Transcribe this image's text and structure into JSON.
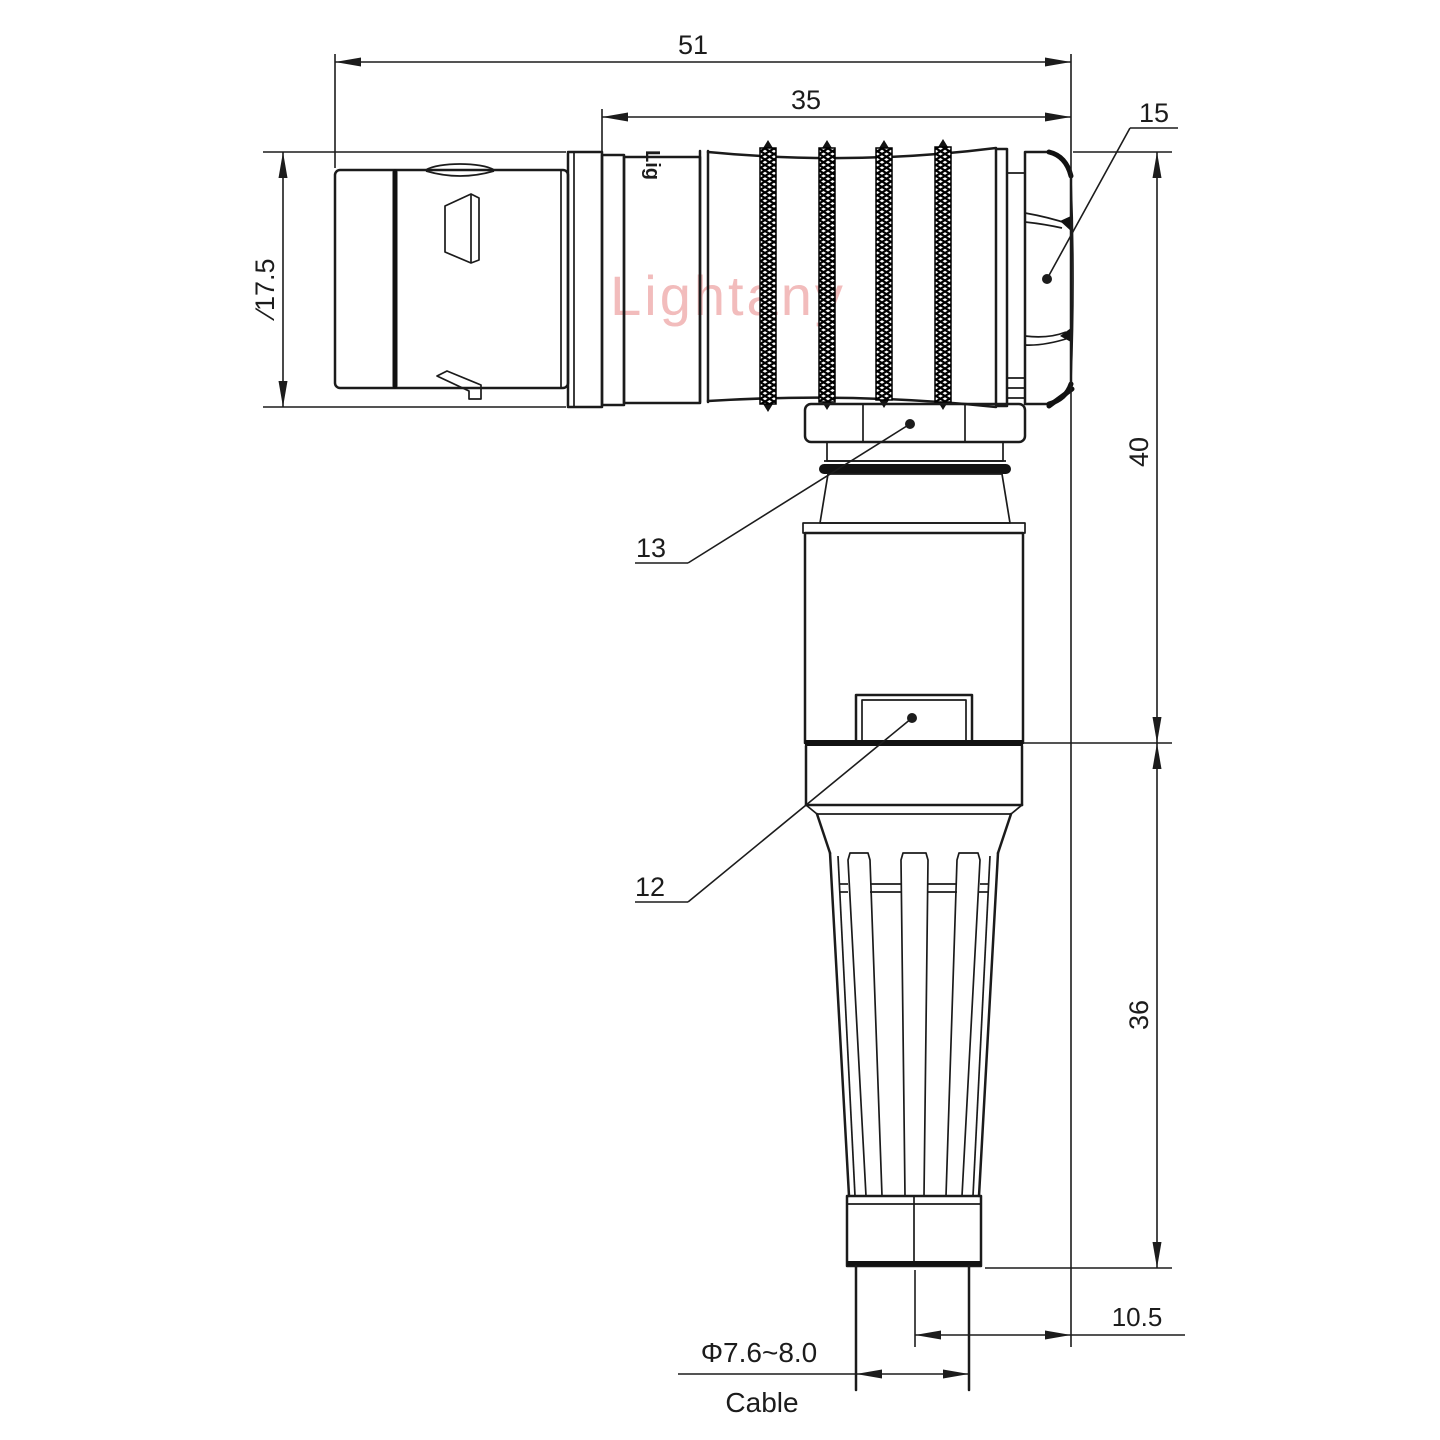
{
  "watermark": "Lightany",
  "body_marking": "Lig",
  "dimensions": {
    "overall_length": "51",
    "rear_section_length": "35",
    "coupling_diameter": "∕17.5",
    "right_angle_height": "40",
    "boot_height": "36",
    "cable_offset": "10.5",
    "cable_diameter": "Φ7.6~8.0",
    "cable_label": "Cable"
  },
  "callouts": {
    "hex_nut": "15",
    "coupling_nut": "13",
    "latch": "12"
  }
}
